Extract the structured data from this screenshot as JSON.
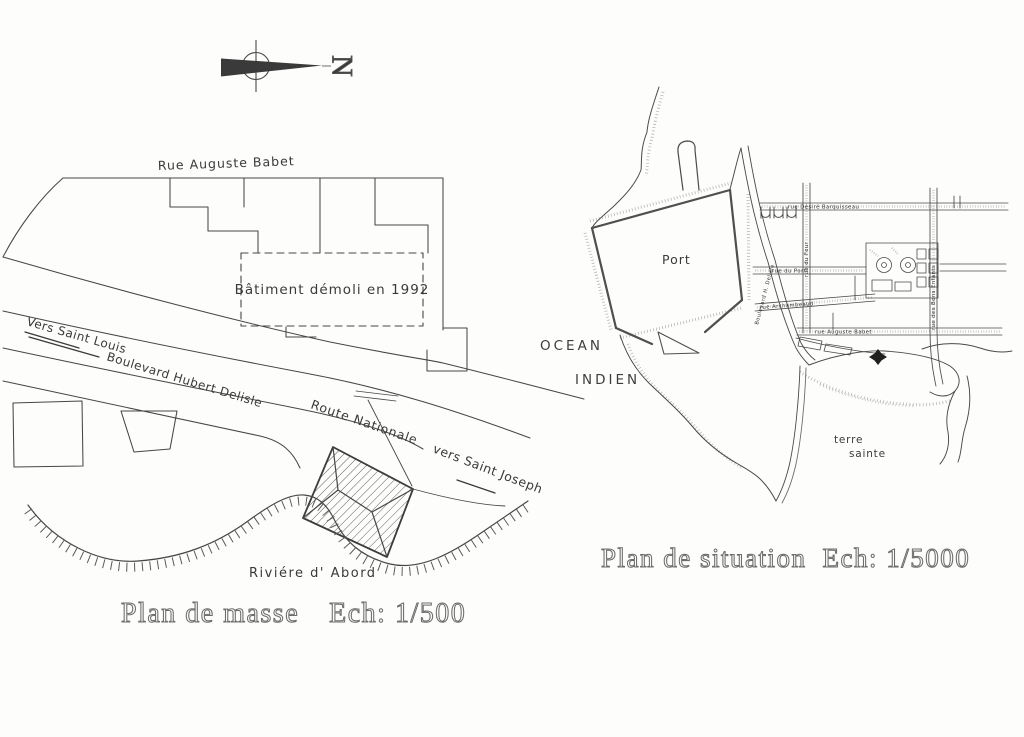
{
  "page": {
    "background": "#fdfdfc",
    "ink": "#3f3f3f",
    "title_ink": "#6d6d6d"
  },
  "north_arrow": {
    "label": "N",
    "icon": "compass-north-arrow"
  },
  "plan_masse": {
    "title": "Plan de masse",
    "scale": "Ech: 1/500",
    "labels": {
      "rue_auguste_babet": "Rue Auguste Babet",
      "batiment_demoli": "Bâtiment démoli en 1992",
      "vers_saint_louis": "Vers Saint Louis",
      "boulevard_hubert_delisle": "Boulevard Hubert Delisle",
      "route_nationale": "Route Nationale",
      "vers_saint_joseph": "vers Saint Joseph",
      "riviere_d_abord": "Riviére d' Abord"
    }
  },
  "plan_situation": {
    "title": "Plan de situation",
    "scale": "Ech: 1/5000",
    "site_marker_icon": "location-star",
    "labels": {
      "ocean_line1": "OCEAN",
      "ocean_line2": "INDIEN",
      "port": "Port",
      "terre_sainte_line1": "terre",
      "terre_sainte_line2": "sainte",
      "rue_desire_barquisseau": "rue Désiré Barquisseau",
      "rue_du_port": "rue du Port",
      "rue_archambeaud": "rue Archambeaud",
      "rue_auguste_babet": "rue Auguste Babet",
      "boulevard_h_delisle": "Boulevard H. Delisle",
      "rue_des_bons_enfants": "rue des Bons Enfants",
      "rue_du_four": "rue du Four"
    }
  }
}
